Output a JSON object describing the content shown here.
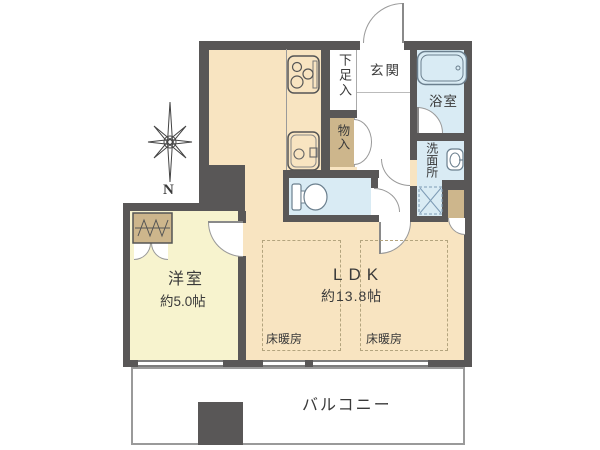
{
  "plan": {
    "title": "apartment-floor-plan",
    "compass": {
      "label": "N"
    },
    "rooms": {
      "entrance": {
        "label": "玄関"
      },
      "shoe_storage": {
        "label": "下足入"
      },
      "bathroom": {
        "label": "浴室"
      },
      "washroom": {
        "label": "洗面所"
      },
      "storage": {
        "label": "物入"
      },
      "western_room": {
        "label": "洋室",
        "size": "約5.0帖"
      },
      "ldk": {
        "label": "LDK",
        "size": "約13.8帖"
      },
      "balcony": {
        "label": "バルコニー"
      },
      "floor_heating_1": {
        "label": "床暖房"
      },
      "floor_heating_2": {
        "label": "床暖房"
      }
    },
    "icons": {
      "compass": "compass-rose-icon",
      "stove": "stove-icon",
      "kitchen_sink": "kitchen-sink-icon",
      "bathtub": "bathtub-icon",
      "washbasin": "washbasin-icon",
      "toilet": "toilet-icon",
      "washer_space": "washing-machine-space-icon",
      "hanger_closet": "hanger-closet-icon"
    },
    "colors": {
      "wall": "#595757",
      "ldk_floor": "#F8E4C1",
      "western_room_floor": "#F7F3CE",
      "wet_area_floor": "#D9EBF4",
      "closet": "#CDB68C",
      "balcony_border": "#9A9A9A"
    }
  }
}
